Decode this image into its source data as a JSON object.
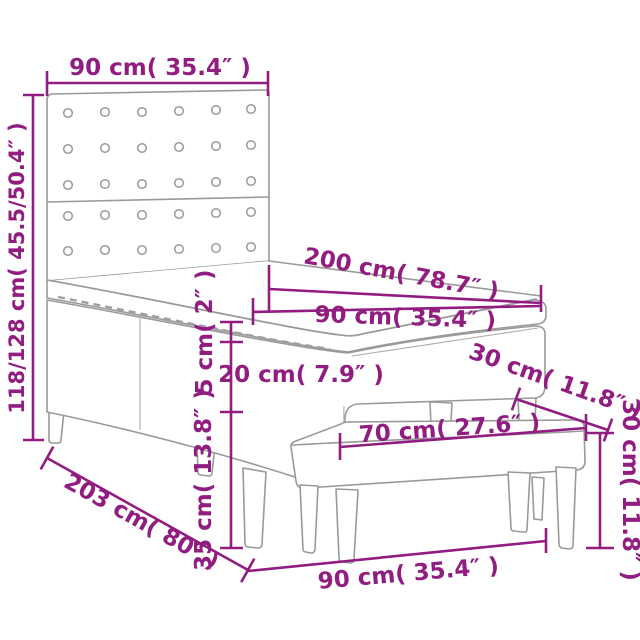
{
  "diagram": {
    "subject": "box spring bed with headboard and bench",
    "colors": {
      "dimension": "#911d81",
      "outline": "#9a9a9a",
      "background": "#ffffff"
    },
    "dimensions": [
      {
        "name": "headboard-width",
        "label": "90 cm( 35.4″ )"
      },
      {
        "name": "bed-height",
        "label": "118/128 cm( 45.5/50.4″ )"
      },
      {
        "name": "bed-length",
        "label": "200 cm( 78.7″ )"
      },
      {
        "name": "mattress-width",
        "label": "90 cm( 35.4″ )"
      },
      {
        "name": "mattress-thickness",
        "label": "5 cm( 2″ )"
      },
      {
        "name": "base-height",
        "label": "20 cm( 7.9″ )"
      },
      {
        "name": "bench-depth",
        "label": "30 cm( 11.8″ )"
      },
      {
        "name": "bench-seat-width",
        "label": "70 cm( 27.6″ )"
      },
      {
        "name": "leg-height",
        "label": "35 cm( 13.8″ )"
      },
      {
        "name": "floor-length",
        "label": "203 cm( 80″ )"
      },
      {
        "name": "bench-width",
        "label": "90 cm( 35.4″ )"
      },
      {
        "name": "bench-height",
        "label": "30 cm( 11.8″ )"
      }
    ]
  }
}
